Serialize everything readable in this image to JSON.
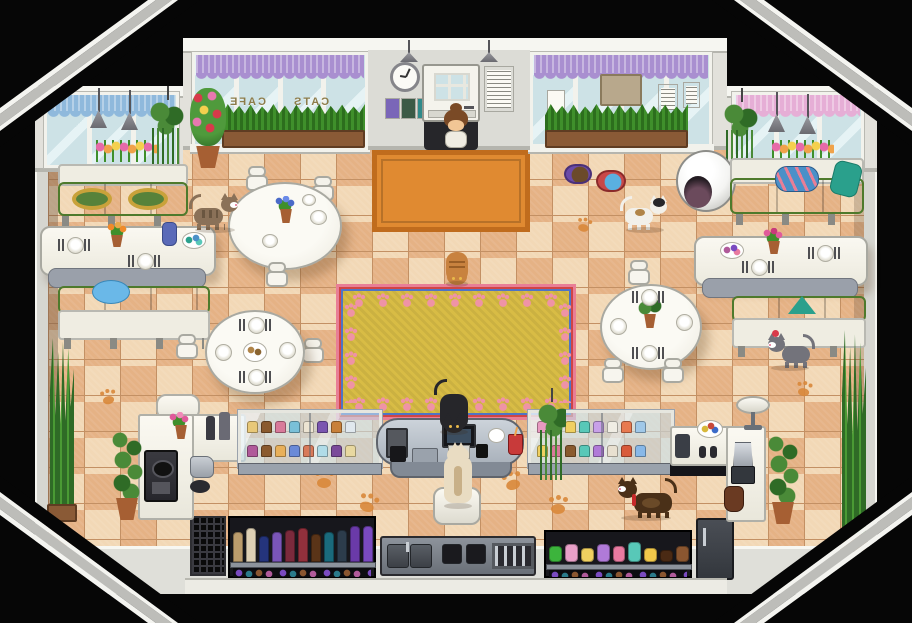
{
  "scene": {
    "name": "Cats Cafe — pixel RPG interior"
  },
  "window_sign": {
    "left_word": "CAFE",
    "right_word": "CATS"
  },
  "colors": {
    "bg": "#060606",
    "wall": "#e2e1db",
    "wall_trim": "#f6f6f1",
    "wall_shadow": "#b5b5ae",
    "floor_a": "#f2d8b6",
    "floor_b": "#e5b285",
    "floor_line": "#c39064",
    "glass": "#cde2e6",
    "glass_hi": "#e6f3f5",
    "frame_white": "#f2f2ec",
    "curtain_purple": "#a98fd0",
    "curtain_blue": "#8fb9dc",
    "curtain_pink": "#e6aed6",
    "grass": "#3f8f2b",
    "grass_dark": "#2c6e1d",
    "planter": "#8a5a36",
    "leaf": "#4a8a38",
    "leaf_dark": "#2f6b26",
    "pot": "#a65f33",
    "mat_orange": "#e08a31",
    "mat_border": "#c06c1d",
    "rug_gold": "#d8bc45",
    "rug_pink": "#e87e96",
    "rug_red": "#d04545",
    "rug_blue": "#4f74c5",
    "rug_paw": "#ef93a6",
    "bench_green": "#8db954",
    "bench_green_dark": "#639238",
    "bench_white": "#efede2",
    "table_white": "#f4f2ea",
    "counter_front": "#828a95",
    "case_glass": "rgba(198,224,235,0.6)",
    "paw_orange": "#d9883a",
    "npc_hair": "#7a4a26",
    "skin": "#f1c695",
    "cat_tabby": "#8a7158",
    "cat_white": "#f2f0ea",
    "cat_orange": "#c8823f",
    "cat_black": "#26262a",
    "cat_gray": "#73737b",
    "cat_tortie": "#4a3018",
    "cat_cream": "#e9dcc2",
    "dome_white": "#f4f4f2",
    "dome_hole": "#241c22",
    "dome_inner": "#6b4a5c",
    "pillow_blue": "#4a90c8",
    "pillow_teal": "#2aa08c",
    "cushion_blue": "#6ab8e8",
    "cushion_gold": "#c9a23a",
    "bowl_purple": "#6a4aa8",
    "bowl_red": "#c84848",
    "water_blue": "#5ab0e0",
    "kibble": "#6b4a2a"
  },
  "display_case_left": {
    "row1": [
      "#e8c878",
      "#8a5a2e",
      "#d87a9a",
      "#7ac0d8",
      "#ece4d2",
      "#7a55b0",
      "#c8803a",
      "#e0e8ee"
    ],
    "row2": [
      "#b05a9a",
      "#8a5a2e",
      "#e8b05a",
      "#6a8ad8",
      "#d87a5a",
      "#b0dce8",
      "#7a4a9a",
      "#e8d8a0"
    ]
  },
  "display_case_right": {
    "row1": [
      "#e89ac0",
      "#8a5a2e",
      "#f0d060",
      "#58c8b8",
      "#c8a0e8",
      "#f0ede4",
      "#e87a50",
      "#a0c8e8"
    ],
    "row2": [
      "#f0d060",
      "#d87a9a",
      "#8a5a2e",
      "#58c8b8",
      "#b07ad8",
      "#e8e0d0",
      "#d85a3a",
      "#88b8e8"
    ]
  },
  "supply_shelf_items": [
    [
      "#bb9c6c",
      30
    ],
    [
      "#ded0b4",
      34
    ],
    [
      "#24347c",
      26
    ],
    [
      "#7a55b8",
      30
    ],
    [
      "#7b2a3c",
      32
    ],
    [
      "#92303c",
      34
    ],
    [
      "#5a3418",
      28
    ],
    [
      "#1a6a7c",
      30
    ],
    [
      "#2c3c4c",
      32
    ],
    [
      "#6a3aa8",
      36
    ],
    [
      "#7a4ac0",
      36
    ]
  ],
  "dessert_shelf_items": [
    [
      "#3cb43c",
      16
    ],
    [
      "#e8a0c8",
      18
    ],
    [
      "#f0d060",
      14
    ],
    [
      "#b07ad8",
      18
    ],
    [
      "#e87aa0",
      16
    ],
    [
      "#58c8b8",
      20
    ],
    [
      "#f0c84a",
      14
    ],
    [
      "#4a2a14",
      12
    ],
    [
      "#8a5630",
      16
    ]
  ]
}
